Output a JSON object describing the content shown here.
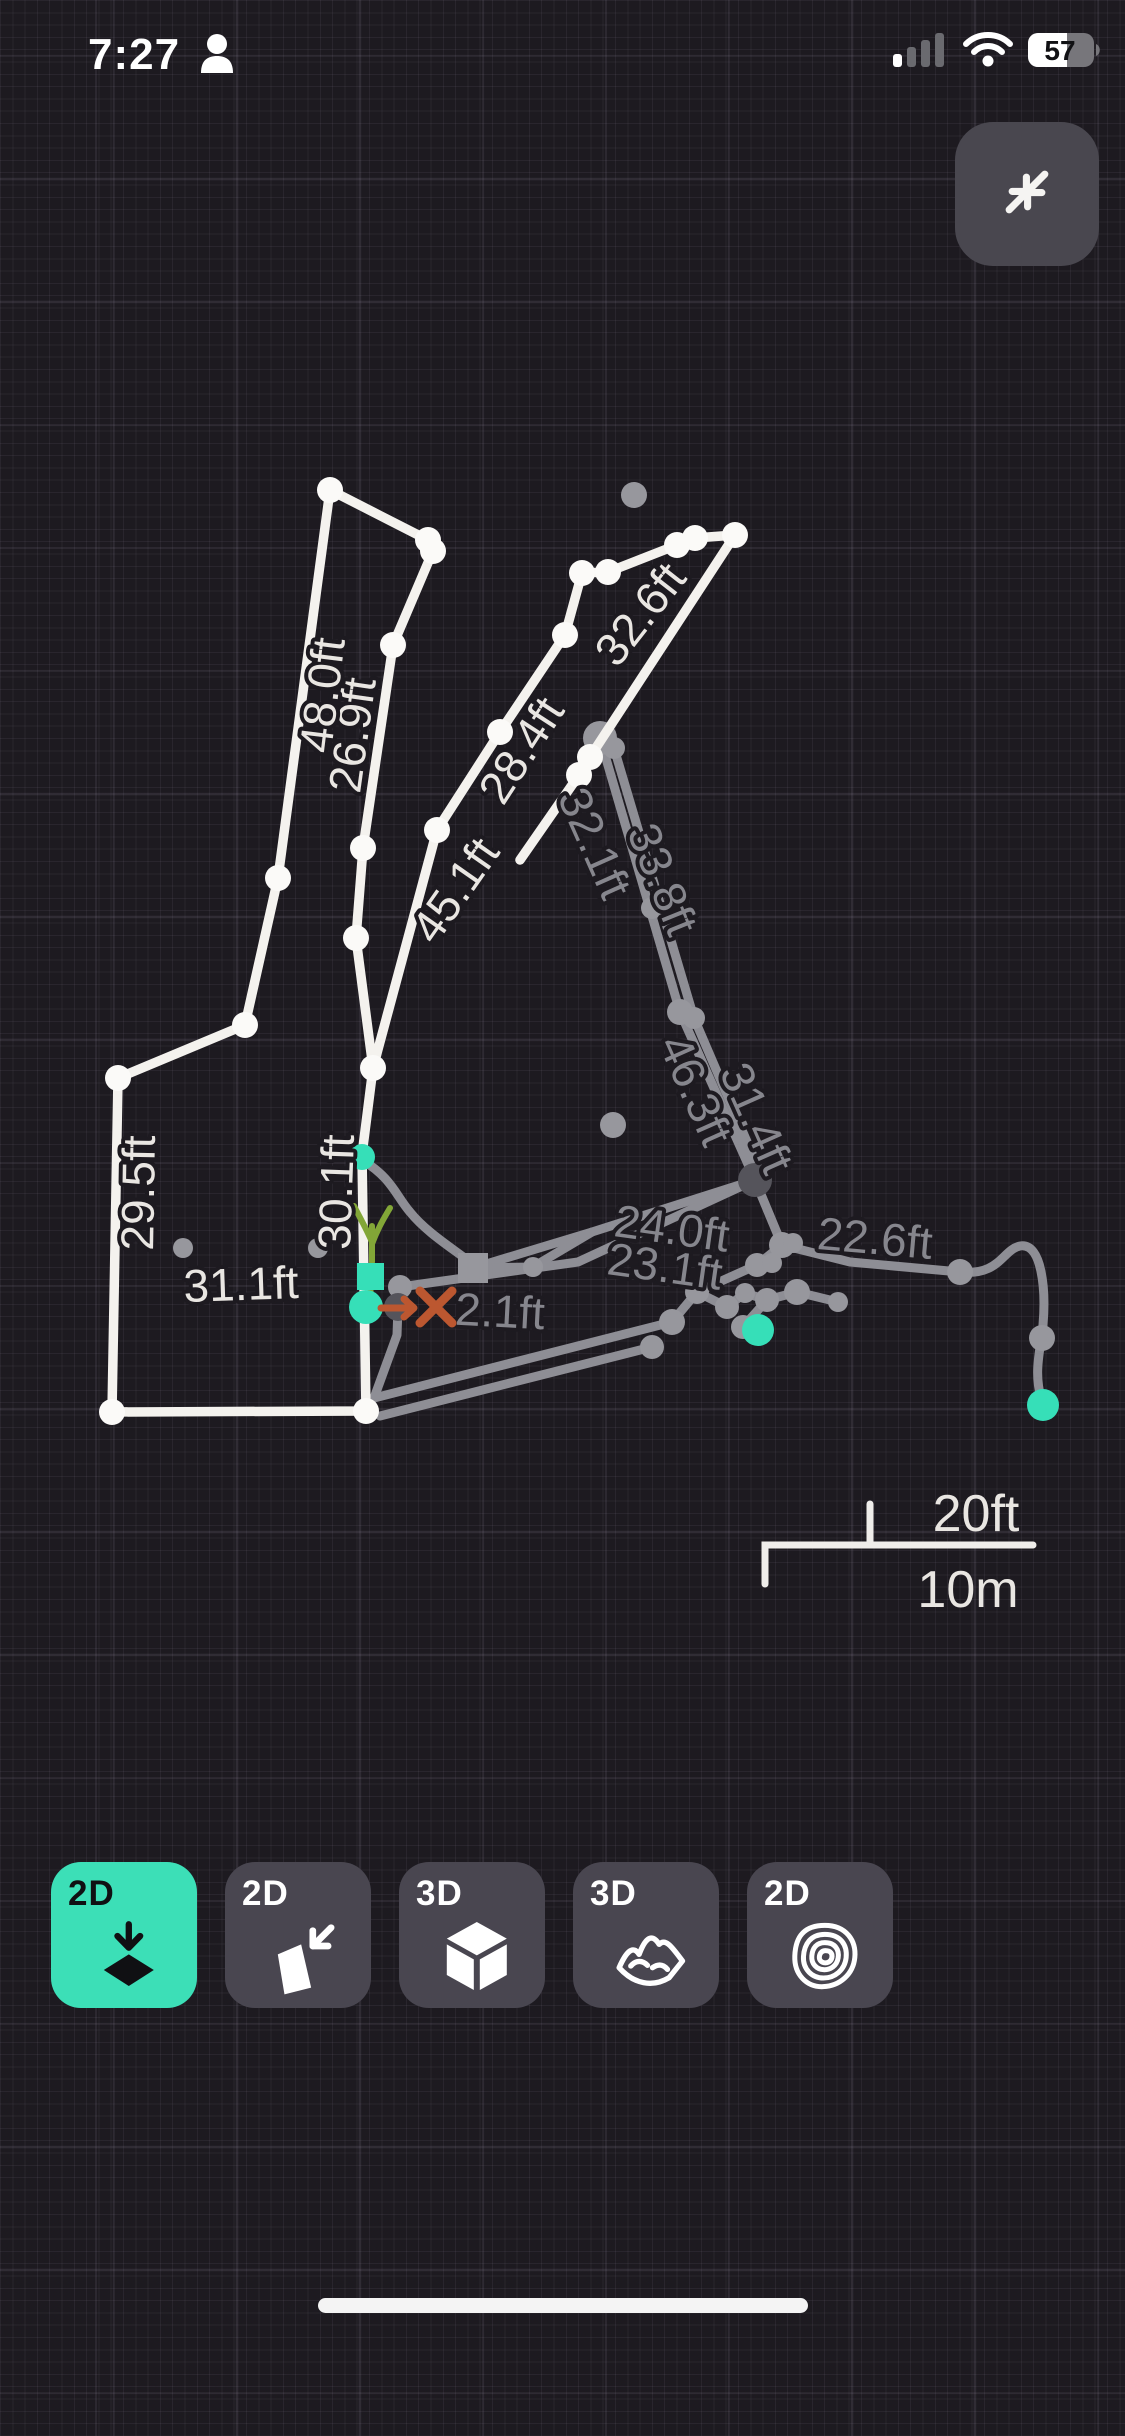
{
  "status_bar": {
    "time": "7:27",
    "battery_percent": "57"
  },
  "collapse_button": {
    "icon": "collapse-arrows-icon"
  },
  "colors": {
    "bg": "#1d1a20",
    "white_line": "#f4f2ee",
    "gray_line": "#8e8e95",
    "label_white": "#e9e6e2",
    "label_gray": "#86868d",
    "teal": "#36dfb8",
    "orange": "#bc5730",
    "green": "#82a637",
    "dark_node": "#55545b",
    "white_node": "#fbfaf8",
    "gray_node": "#97979d",
    "button_bg": "#494650",
    "button_selected": "#3cdfb7",
    "scale_bar": "#efedea"
  },
  "map": {
    "white_paths": [
      "M330,490 L428,540 L433,551 L393,645 L363,848 L356,938 L373,1068 L362,1155 L366,1411 L112,1412 L118,1078 L245,1025 L278,878 Z",
      "M373,1068 L437,830 L500,732 L565,635 L582,573 L608,572 L677,545 L695,538 L735,535 L590,757 L579,775 L520,860"
    ],
    "gray_paths": [
      "M600,738 L680,1012 L755,1180",
      "M614,748 L694,1018 L760,1172",
      "M755,1180 L592,1232 L473,1268",
      "M755,1180 L578,1262 L400,1287",
      "M755,1180 L782,1245 L850,1262 L960,1272 C1000,1276 1002,1250 1020,1246 C1042,1242 1046,1290 1043,1325 C1041,1350 1032,1372 1043,1405",
      "M362,1160 C392,1178 396,1196 410,1212 C426,1232 452,1248 470,1262",
      "M755,1180 L782,1245 L757,1265 L697,1292 L672,1322",
      "M672,1322 L374,1398",
      "M697,1292 L727,1307 L745,1293 L767,1300 L797,1292 L838,1302",
      "M767,1300 L743,1327",
      "M380,1416 L652,1347",
      "M473,1268 L533,1267 L592,1232",
      "M400,1287 L398,1307 L397,1335 L374,1398"
    ],
    "white_nodes": [
      [
        330,
        490
      ],
      [
        428,
        540
      ],
      [
        433,
        551
      ],
      [
        393,
        645
      ],
      [
        363,
        848
      ],
      [
        356,
        938
      ],
      [
        278,
        878
      ],
      [
        245,
        1025
      ],
      [
        118,
        1078
      ],
      [
        112,
        1412
      ],
      [
        366,
        1411
      ],
      [
        373,
        1068
      ],
      [
        437,
        830
      ],
      [
        500,
        732
      ],
      [
        565,
        635
      ],
      [
        582,
        573
      ],
      [
        608,
        572
      ],
      [
        677,
        545
      ],
      [
        695,
        538
      ],
      [
        735,
        535
      ],
      [
        590,
        757
      ],
      [
        579,
        775
      ]
    ],
    "gray_nodes": [
      [
        600,
        738,
        17
      ],
      [
        614,
        748,
        11
      ],
      [
        652,
        908,
        11
      ],
      [
        680,
        1012,
        13
      ],
      [
        694,
        1018,
        11
      ],
      [
        782,
        1245,
        13
      ],
      [
        793,
        1243,
        10
      ],
      [
        757,
        1265,
        12
      ],
      [
        772,
        1263,
        10
      ],
      [
        797,
        1292,
        13
      ],
      [
        767,
        1300,
        12
      ],
      [
        745,
        1293,
        10
      ],
      [
        697,
        1292,
        12
      ],
      [
        727,
        1307,
        12
      ],
      [
        672,
        1322,
        13
      ],
      [
        743,
        1327,
        12
      ],
      [
        838,
        1302,
        10
      ],
      [
        652,
        1347,
        12
      ],
      [
        533,
        1267,
        10
      ],
      [
        400,
        1287,
        12
      ],
      [
        960,
        1272,
        13
      ],
      [
        1042,
        1338,
        13
      ]
    ],
    "floating_dots": [
      [
        634,
        495,
        13
      ],
      [
        613,
        1125,
        13
      ],
      [
        183,
        1248,
        10
      ],
      [
        318,
        1248,
        10
      ]
    ],
    "dark_nodes": [
      [
        755,
        1180,
        17
      ],
      [
        398,
        1307,
        14
      ]
    ],
    "square_node": {
      "x": 473,
      "y": 1268,
      "size": 30
    },
    "teal_nodes": [
      [
        362,
        1157,
        13
      ],
      [
        366,
        1307,
        17
      ],
      [
        758,
        1330,
        16
      ],
      [
        1043,
        1405,
        16
      ]
    ],
    "teal_square": {
      "x": 357,
      "y": 1263,
      "size": 27
    },
    "plant_marker": {
      "paths": [
        "M372,1262 L372,1226",
        "M372,1242 C366,1228 360,1218 354,1206",
        "M372,1244 C378,1228 384,1218 390,1208",
        "M370,1288 L374,1312"
      ]
    },
    "orange_marker": {
      "arrow": "M381,1308 L413,1308 M404,1299 L414,1308 L404,1317",
      "cross": "M420,1291 L452,1323 M452,1291 L420,1323"
    },
    "segment_labels": [
      {
        "text": "26.9ft",
        "x": 352,
        "y": 735,
        "rot": -82,
        "tone": "white"
      },
      {
        "text": "48.0ft",
        "x": 322,
        "y": 695,
        "rot": -83,
        "tone": "white"
      },
      {
        "text": "28.4ft",
        "x": 521,
        "y": 750,
        "rot": -57,
        "tone": "white"
      },
      {
        "text": "45.1ft",
        "x": 455,
        "y": 890,
        "rot": -55,
        "tone": "white"
      },
      {
        "text": "32.6ft",
        "x": 640,
        "y": 614,
        "rot": -52,
        "tone": "white"
      },
      {
        "text": "32.1ft",
        "x": 595,
        "y": 843,
        "rot": 66,
        "tone": "gray"
      },
      {
        "text": "33.8ft",
        "x": 663,
        "y": 879,
        "rot": 68,
        "tone": "gray"
      },
      {
        "text": "46.3ft",
        "x": 696,
        "y": 1090,
        "rot": 66,
        "tone": "gray"
      },
      {
        "text": "31.4ft",
        "x": 757,
        "y": 1118,
        "rot": 66,
        "tone": "gray"
      },
      {
        "text": "24.0ft",
        "x": 672,
        "y": 1228,
        "rot": 8,
        "tone": "gray"
      },
      {
        "text": "23.1ft",
        "x": 665,
        "y": 1266,
        "rot": 8,
        "tone": "gray"
      },
      {
        "text": "22.6ft",
        "x": 875,
        "y": 1238,
        "rot": 5,
        "tone": "gray"
      },
      {
        "text": "2.1ft",
        "x": 500,
        "y": 1311,
        "rot": 3,
        "tone": "gray"
      },
      {
        "text": "29.5ft",
        "x": 138,
        "y": 1193,
        "rot": -89,
        "tone": "white"
      },
      {
        "text": "30.1ft",
        "x": 336,
        "y": 1192,
        "rot": -88,
        "tone": "white"
      },
      {
        "text": "31.1ft",
        "x": 241,
        "y": 1284,
        "rot": -2,
        "tone": "white"
      }
    ],
    "scale_bar": {
      "path": "M765,1584 L765,1545 L1033,1545 M870,1545 L870,1504",
      "imperial": "20ft",
      "metric": "10m",
      "imperial_pos": [
        976,
        1514
      ],
      "metric_pos": [
        968,
        1590
      ]
    }
  },
  "view_buttons": [
    {
      "label": "2D",
      "icon": "plan-view-icon",
      "selected": true
    },
    {
      "label": "2D",
      "icon": "profile-view-icon",
      "selected": false
    },
    {
      "label": "3D",
      "icon": "cube-view-icon",
      "selected": false
    },
    {
      "label": "3D",
      "icon": "terrain-view-icon",
      "selected": false
    },
    {
      "label": "2D",
      "icon": "contour-view-icon",
      "selected": false
    }
  ]
}
